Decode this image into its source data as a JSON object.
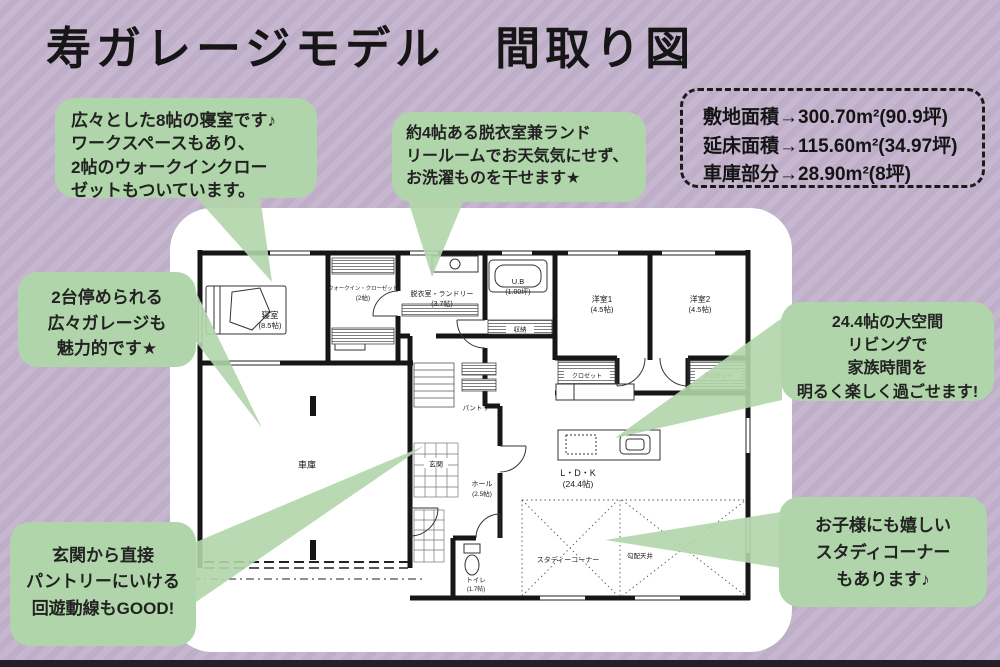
{
  "title": "寿ガレージモデル　間取り図",
  "area_info": {
    "line1": "敷地面積→300.70m²(90.9坪)",
    "line2": "延床面積→115.60m²(34.97坪)",
    "line3": "車庫部分→28.90m²(8坪)"
  },
  "callouts": {
    "bedroom": {
      "lines": [
        "広々とした8帖の寝室です♪",
        "ワークスペースもあり、",
        "2帖のウォークインクロー",
        "ゼットもついています。"
      ]
    },
    "laundry": {
      "lines": [
        "約4帖ある脱衣室兼ランド",
        "リールームでお天気気にせず、",
        "お洗濯ものを干せます★"
      ]
    },
    "garage": {
      "lines": [
        "2台停められる",
        "広々ガレージも",
        "魅力的です★"
      ]
    },
    "living": {
      "lines": [
        "24.4帖の大空間",
        "リビングで",
        "家族時間を",
        "明るく楽しく過ごせます!"
      ]
    },
    "pantry": {
      "lines": [
        "玄関から直接",
        "パントリーにいける",
        "回遊動線もGOOD!"
      ]
    },
    "study": {
      "lines": [
        "お子様にも嬉しい",
        "スタディコーナー",
        "もあります♪"
      ]
    }
  },
  "floorplan": {
    "bedroom": {
      "name": "寝室",
      "size": "(8.5帖)"
    },
    "wic": {
      "name": "ウォークイン・クローゼット",
      "size": "(2帖)"
    },
    "laundry": {
      "name": "脱衣室・ランドリー",
      "size": "(3.7帖)"
    },
    "bath": {
      "name": "U.B",
      "size": "(1.00坪)"
    },
    "storage": {
      "name": "収納"
    },
    "room1": {
      "name": "洋室1",
      "size": "(4.5帖)"
    },
    "room2": {
      "name": "洋室2",
      "size": "(4.5帖)"
    },
    "closet": {
      "name": "クロゼット"
    },
    "garage": {
      "name": "車庫"
    },
    "pantry": {
      "name": "パントリー"
    },
    "entrance": {
      "name": "玄関"
    },
    "hall": {
      "name": "ホール",
      "size": "(2.5帖)"
    },
    "ldk": {
      "name": "L・D・K",
      "size": "(24.4帖)"
    },
    "toilet": {
      "name": "トイレ",
      "size": "(1.7帖)"
    },
    "study": {
      "name": "スタディーコーナー"
    },
    "ceiling": {
      "name": "勾配天井"
    }
  },
  "colors": {
    "background_purple": "#c3b2cb",
    "callout_green": "#b1d5aa",
    "plan_white": "#ffffff",
    "wall_black": "#161616",
    "text_dark": "#222222"
  }
}
